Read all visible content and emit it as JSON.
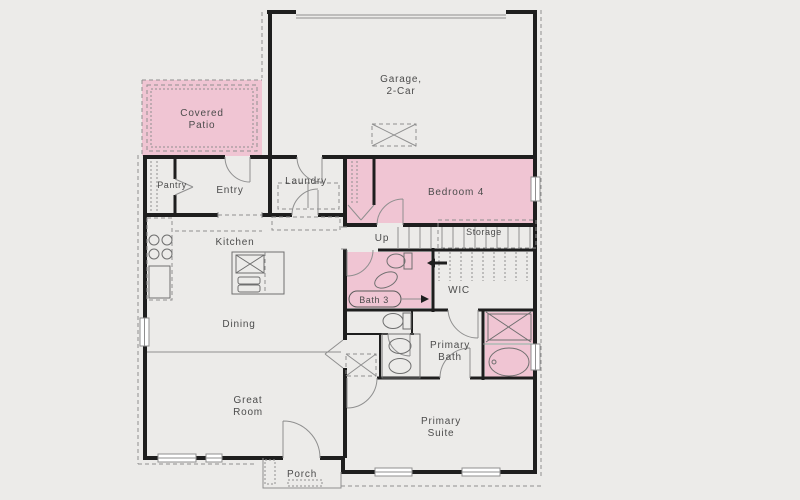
{
  "diagram_type": "residential-floor-plan",
  "colors": {
    "background": "#ecebe9",
    "highlight": "#f0c5d3",
    "wall": "#1e1e1e",
    "line": "#8f8f8f",
    "text": "#4c4c4c",
    "window_fill": "#ffffff"
  },
  "rooms": {
    "garage": {
      "line1": "Garage,",
      "line2": "2-Car"
    },
    "covered_patio": {
      "line1": "Covered",
      "line2": "Patio"
    },
    "pantry": {
      "label": "Pantry"
    },
    "entry": {
      "label": "Entry"
    },
    "laundry": {
      "label": "Laundry"
    },
    "bedroom_4": {
      "label": "Bedroom 4"
    },
    "stairs": {
      "up_label": "Up"
    },
    "storage": {
      "label": "Storage"
    },
    "kitchen": {
      "label": "Kitchen"
    },
    "bath_3": {
      "label": "Bath 3"
    },
    "wic": {
      "label": "WIC"
    },
    "dining": {
      "label": "Dining"
    },
    "primary_bath": {
      "line1": "Primary",
      "line2": "Bath"
    },
    "great_room": {
      "line1": "Great",
      "line2": "Room"
    },
    "primary_suite": {
      "line1": "Primary",
      "line2": "Suite"
    },
    "porch": {
      "label": "Porch"
    }
  }
}
